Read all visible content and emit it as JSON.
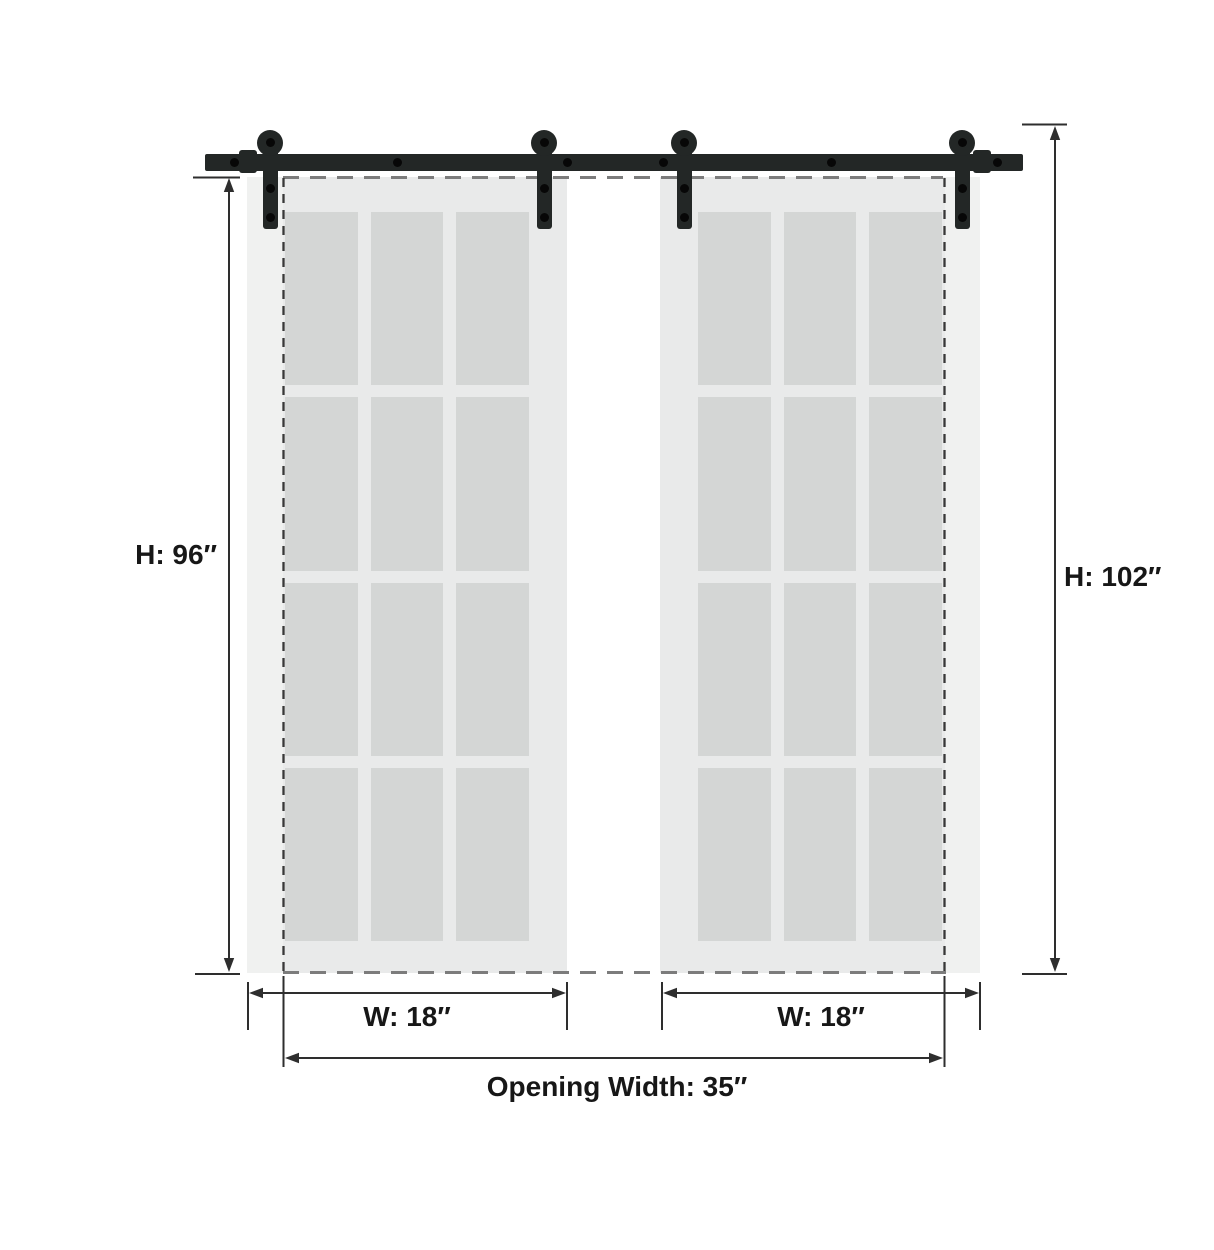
{
  "diagram": {
    "title": "Double sliding barn door dimension diagram",
    "labels": {
      "door_height": "H: 96″",
      "total_height": "H: 102″",
      "door_width_left": "W: 18″",
      "door_width_right": "W: 18″",
      "opening_width": "Opening Width: 35″"
    },
    "measurements": {
      "door_height_in": 96,
      "total_height_in": 102,
      "door_width_in": 18,
      "opening_width_in": 35
    },
    "doors": {
      "count": 2,
      "lites_per_door": 12,
      "lite_grid": "3 x 4"
    },
    "colors": {
      "background": "#ffffff",
      "hardware": "#232726",
      "bolt": "#070707",
      "door_face": "#f0f1f0",
      "door_inner": "#e9eaea",
      "glass_pane": "#d4d6d5",
      "dimension_line": "#2e2e2e",
      "dash_horizontal": "#7c7c7c",
      "dash_vertical": "#383838"
    }
  }
}
